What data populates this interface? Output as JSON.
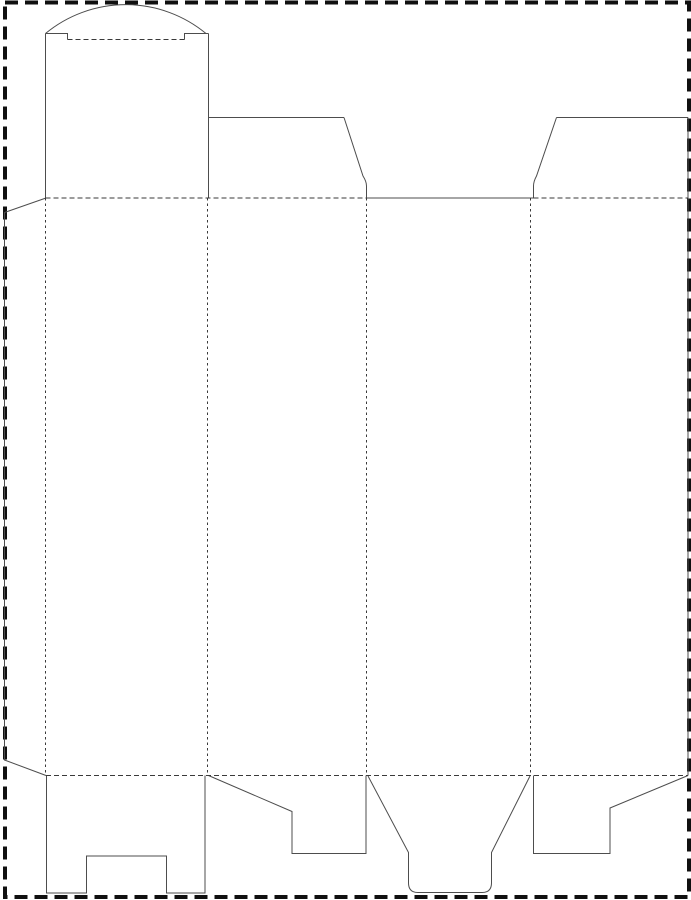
{
  "page": {
    "width": 691,
    "height": 900,
    "background": "#ffffff"
  },
  "colors": {
    "cut_line": "#4d4d4d",
    "fold_line": "#3a3a3a",
    "page_border": "#101010",
    "background": "#ffffff"
  },
  "line_styles": {
    "border": {
      "width": 4,
      "dash": "13 7"
    },
    "cut": {
      "width": 1,
      "dash": ""
    },
    "fold_h": {
      "width": 1,
      "dash": "5 3"
    },
    "fold_v": {
      "width": 1,
      "dash": "2.5 3"
    }
  },
  "dieline": {
    "paths": [
      {
        "name": "page-border",
        "kind": "border",
        "d": "M5,2.5 H689 V897 H5 Z"
      },
      {
        "name": "tuck-lid-arc",
        "kind": "cut",
        "d": "M45.5,33.5 A126 126 0 0 1 206,33.5"
      },
      {
        "name": "tuck-shoulder-left",
        "kind": "cut",
        "d": "M45.5,33.5 H67.5 V39.5"
      },
      {
        "name": "tuck-shoulder-right",
        "kind": "cut",
        "d": "M184.5,39.5 V33.5 H208.5"
      },
      {
        "name": "tuck-side-left",
        "kind": "cut",
        "d": "M45.5,33.5 V198"
      },
      {
        "name": "tuck-side-right",
        "kind": "cut",
        "d": "M208.5,33.5 V198"
      },
      {
        "name": "dust-flap-left-top",
        "kind": "cut",
        "d": "M208.5,117.5 H344"
      },
      {
        "name": "dust-flap-left-slant",
        "kind": "cut",
        "d": "M344,117.5 L363,176 Q366.5,181.5 366.5,186 L366.5,198"
      },
      {
        "name": "top-center-cut",
        "kind": "cut",
        "d": "M366.5,198 H533.5"
      },
      {
        "name": "dust-flap-right-slant",
        "kind": "cut",
        "d": "M533.5,198 L533.5,186 Q533.5,181.5 536.5,176 L556.5,117.5"
      },
      {
        "name": "dust-flap-right-top",
        "kind": "cut",
        "d": "M556.5,117.5 H688"
      },
      {
        "name": "right-panel-edge",
        "kind": "cut",
        "d": "M688,117.5 V775.5"
      },
      {
        "name": "glue-flap-outline",
        "kind": "cut",
        "d": "M46,198 L4.5,212.5 V760 L46,775.5"
      },
      {
        "name": "bottom-flap-1-outline",
        "kind": "cut",
        "d": "M46.5,775.5 V893 H86.5 V856 H166.5 V893 H205 V775.5"
      },
      {
        "name": "bottom-flap-2-outline",
        "kind": "cut",
        "d": "M208.5,775.5 L292,811.5 V853.5 H366 V775.5"
      },
      {
        "name": "bottom-flap-3-outline",
        "kind": "cut",
        "d": "M368,776 L408.5,852.5 V883 Q408.5,892.5 418,892.5 H482 Q491.5,892.5 491.5,883 V852.5 L530,776"
      },
      {
        "name": "bottom-flap-4-outline",
        "kind": "cut",
        "d": "M533.5,775.5 V853.5 H610 V808 L688,775.5"
      },
      {
        "name": "tuck-lid-fold",
        "kind": "fold_h",
        "d": "M67.5,39.5 H184.5"
      },
      {
        "name": "top-fold-left",
        "kind": "fold_h",
        "d": "M45.5,198 H366.5"
      },
      {
        "name": "top-fold-right",
        "kind": "fold_h",
        "d": "M533.5,198 H688"
      },
      {
        "name": "bottom-fold",
        "kind": "fold_h",
        "d": "M46,775.5 H688"
      },
      {
        "name": "panel-fold-1",
        "kind": "fold_v",
        "d": "M45.5,198 V775.5"
      },
      {
        "name": "panel-fold-2",
        "kind": "fold_v",
        "d": "M207.5,198 V775.5"
      },
      {
        "name": "panel-fold-3",
        "kind": "fold_v",
        "d": "M366.5,198 V775.5"
      },
      {
        "name": "panel-fold-4",
        "kind": "fold_v",
        "d": "M530.5,198 V775.5"
      }
    ]
  }
}
